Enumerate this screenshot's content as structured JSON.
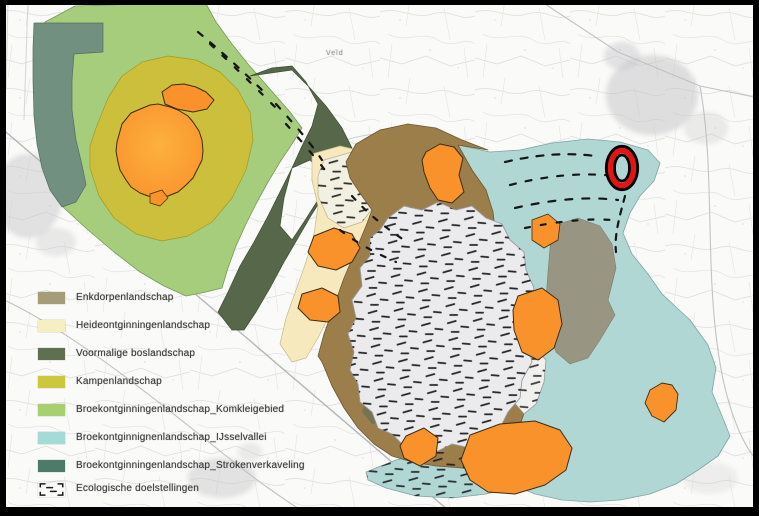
{
  "map": {
    "description": "Scanned thematic landscape-types map with legend and red circled target location",
    "palette": {
      "frame": "#000000",
      "paper": "#fafaf8",
      "komklei": "#a6cd7c",
      "stroken": "#71907f",
      "kampen": "#ccbf3c",
      "heide": "#f6e9be",
      "bos": "#57684a",
      "enkdorpen": "#9c7e4b",
      "ijssel": "#b0d7d4",
      "urban_orange": "#f9922b",
      "graybrown": "#97937f",
      "eco_fill": "#ebebee",
      "eco_dash": "#1c1c1c",
      "outline": "#4a4a40"
    },
    "legend": {
      "items": [
        {
          "label": "Enkdorpenlandschap",
          "color": "#a49d77"
        },
        {
          "label": "Heideontginningenlandschap",
          "color": "#f5efc2"
        },
        {
          "label": "Voormalige boslandschap",
          "color": "#5f7051"
        },
        {
          "label": "Kampenlandschap",
          "color": "#cdc73e"
        },
        {
          "label": "Broekontginningenlandschap_Komkleigebied",
          "color": "#a9d06e"
        },
        {
          "label": "Broekontginnignenlandschap_IJsselvallei",
          "color": "#a3dbd6"
        },
        {
          "label": "Broekontginningenlandschap_Strokenverkaveling",
          "color": "#4e7a6b"
        },
        {
          "label": "Ecologische doelstellingen"
        }
      ]
    },
    "labels": {
      "faint_place": "Veld"
    },
    "annotation": {
      "shape": "ellipse",
      "ring_color": "#e31414",
      "outline_color": "#000000"
    }
  }
}
